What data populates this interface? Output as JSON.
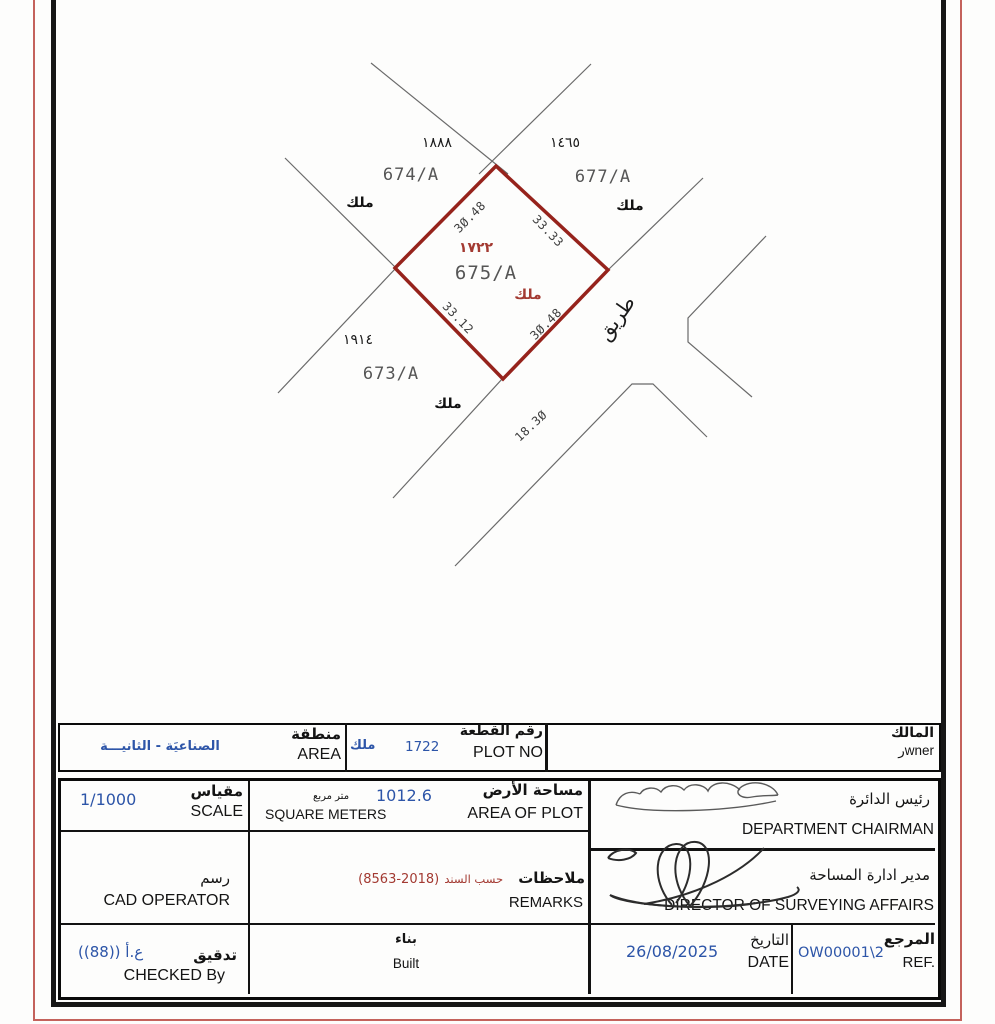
{
  "map": {
    "road_label": "طريق",
    "parcels": {
      "main": {
        "survey_no_ar": "١٧٢٢",
        "plot_no": "675/A",
        "tenure": "ملك"
      },
      "northwest": {
        "survey_no_ar": "١٨٨٨",
        "plot_no": "674/A",
        "tenure": "ملك"
      },
      "northeast": {
        "survey_no_ar": "١٤٦٥",
        "plot_no": "677/A",
        "tenure": "ملك"
      },
      "southwest": {
        "survey_no_ar": "١٩١٤",
        "plot_no": "673/A",
        "tenure": "ملك"
      }
    },
    "dimensions": {
      "nw_edge": "3Ø.48",
      "ne_edge": "33.33",
      "sw_edge": "33.12",
      "se_edge": "3Ø.48",
      "road_frontage": "18.3Ø"
    }
  },
  "owner_strip": {
    "owner": {
      "label_ar": "المالك",
      "label_en": "رwner"
    },
    "plot_no": {
      "label_ar": "رقم القطعة",
      "label_en": "PLOT NO",
      "value": "1722",
      "tenure": "ملك"
    },
    "area": {
      "label_ar": "منطقة",
      "label_en": "AREA",
      "value": "الصناعيَة - الثانيـــة"
    }
  },
  "details_table": {
    "scale": {
      "label_ar": "مقياس",
      "label_en": "SCALE",
      "value": "1/1000"
    },
    "plot_area": {
      "label_ar": "مساحة الأرض",
      "label_en": "AREA OF PLOT",
      "unit_ar": "متر مربع",
      "unit_en": "SQUARE METERS",
      "value": "1012.6"
    },
    "chairman": {
      "label_ar": "رئيس الدائرة",
      "label_en": "DEPARTMENT CHAIRMAN"
    },
    "cad_operator": {
      "label_ar": "رسم",
      "label_en": "CAD OPERATOR"
    },
    "remarks": {
      "label_ar": "ملاحظات",
      "label_en": "REMARKS",
      "note_ar": "حسب السند",
      "note_ref": "(2018-8563)"
    },
    "director": {
      "label_ar": "مدير ادارة المساحة",
      "label_en": "DIRECTOR OF SURVEYING AFFAIRS"
    },
    "checked_by": {
      "label_ar": "تدقيق",
      "label_en": "CHECKED By",
      "value": "ع.أ ((88))"
    },
    "built": {
      "label_ar": "بناء",
      "label_en": "Built"
    },
    "date": {
      "label_ar": "التاريخ",
      "label_en": "DATE",
      "value": "26/08/2025"
    },
    "ref": {
      "label_ar": "المرجع",
      "label_en": "REF.",
      "value": "OW00001\\2"
    }
  },
  "colors": {
    "value_blue": "#2d55a8",
    "note_red": "#a33a32",
    "boundary_red": "#96231c"
  }
}
